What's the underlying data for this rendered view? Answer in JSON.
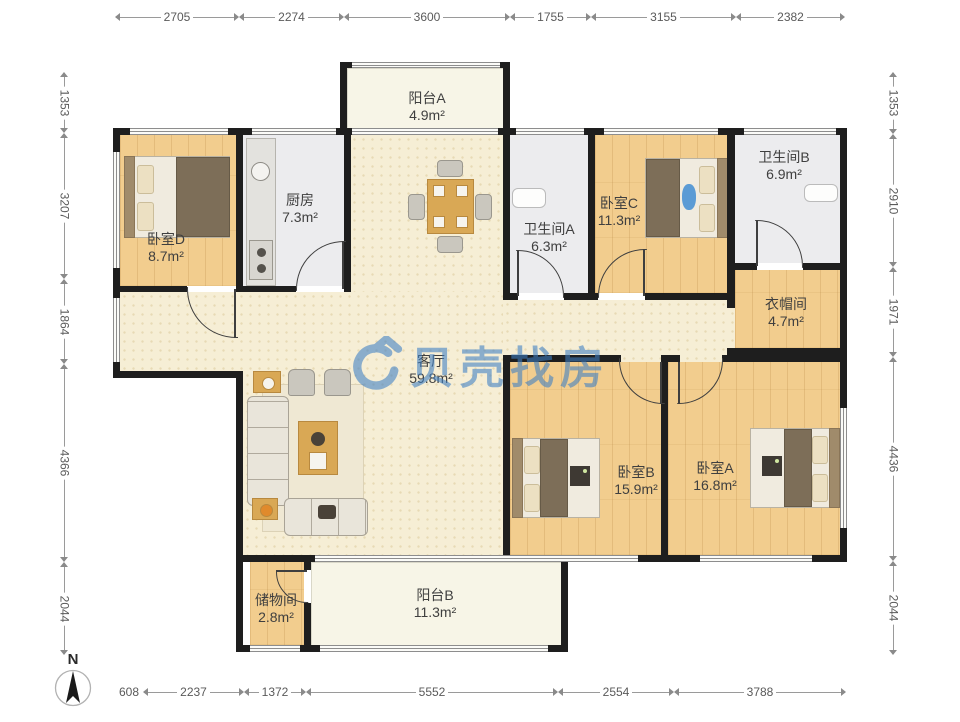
{
  "watermark": {
    "brand": "贝壳找房"
  },
  "compass": {
    "label": "N"
  },
  "rooms": {
    "balcony_a": {
      "name": "阳台A",
      "area": "4.9m²"
    },
    "kitchen": {
      "name": "厨房",
      "area": "7.3m²"
    },
    "bedroom_d": {
      "name": "卧室D",
      "area": "8.7m²"
    },
    "bathroom_a": {
      "name": "卫生间A",
      "area": "6.3m²"
    },
    "bedroom_c": {
      "name": "卧室C",
      "area": "11.3m²"
    },
    "bathroom_b": {
      "name": "卫生间B",
      "area": "6.9m²"
    },
    "cloakroom": {
      "name": "衣帽间",
      "area": "4.7m²"
    },
    "living_room": {
      "name": "客厅",
      "area": "59.8m²"
    },
    "bedroom_b": {
      "name": "卧室B",
      "area": "15.9m²"
    },
    "bedroom_a": {
      "name": "卧室A",
      "area": "16.8m²"
    },
    "storage": {
      "name": "储物间",
      "area": "2.8m²"
    },
    "balcony_b": {
      "name": "阳台B",
      "area": "11.3m²"
    }
  },
  "dimensions": {
    "top": [
      "2705",
      "2274",
      "3600",
      "1755",
      "3155",
      "2382"
    ],
    "bottom": [
      "608",
      "2237",
      "1372",
      "5552",
      "2554",
      "3788"
    ],
    "left": [
      "1353",
      "3207",
      "1864",
      "4366",
      "2044"
    ],
    "right": [
      "1353",
      "2910",
      "1971",
      "4436",
      "2044"
    ]
  },
  "colors": {
    "wall": "#1e1e1e",
    "wood_floor": "#f2cd8e",
    "living_floor": "#f6eed5",
    "wet_floor": "#ececee",
    "balcony_floor": "#f7f5e7",
    "watermark_blue": "#3d7fc4",
    "dimension_text": "#5a5a5a"
  }
}
